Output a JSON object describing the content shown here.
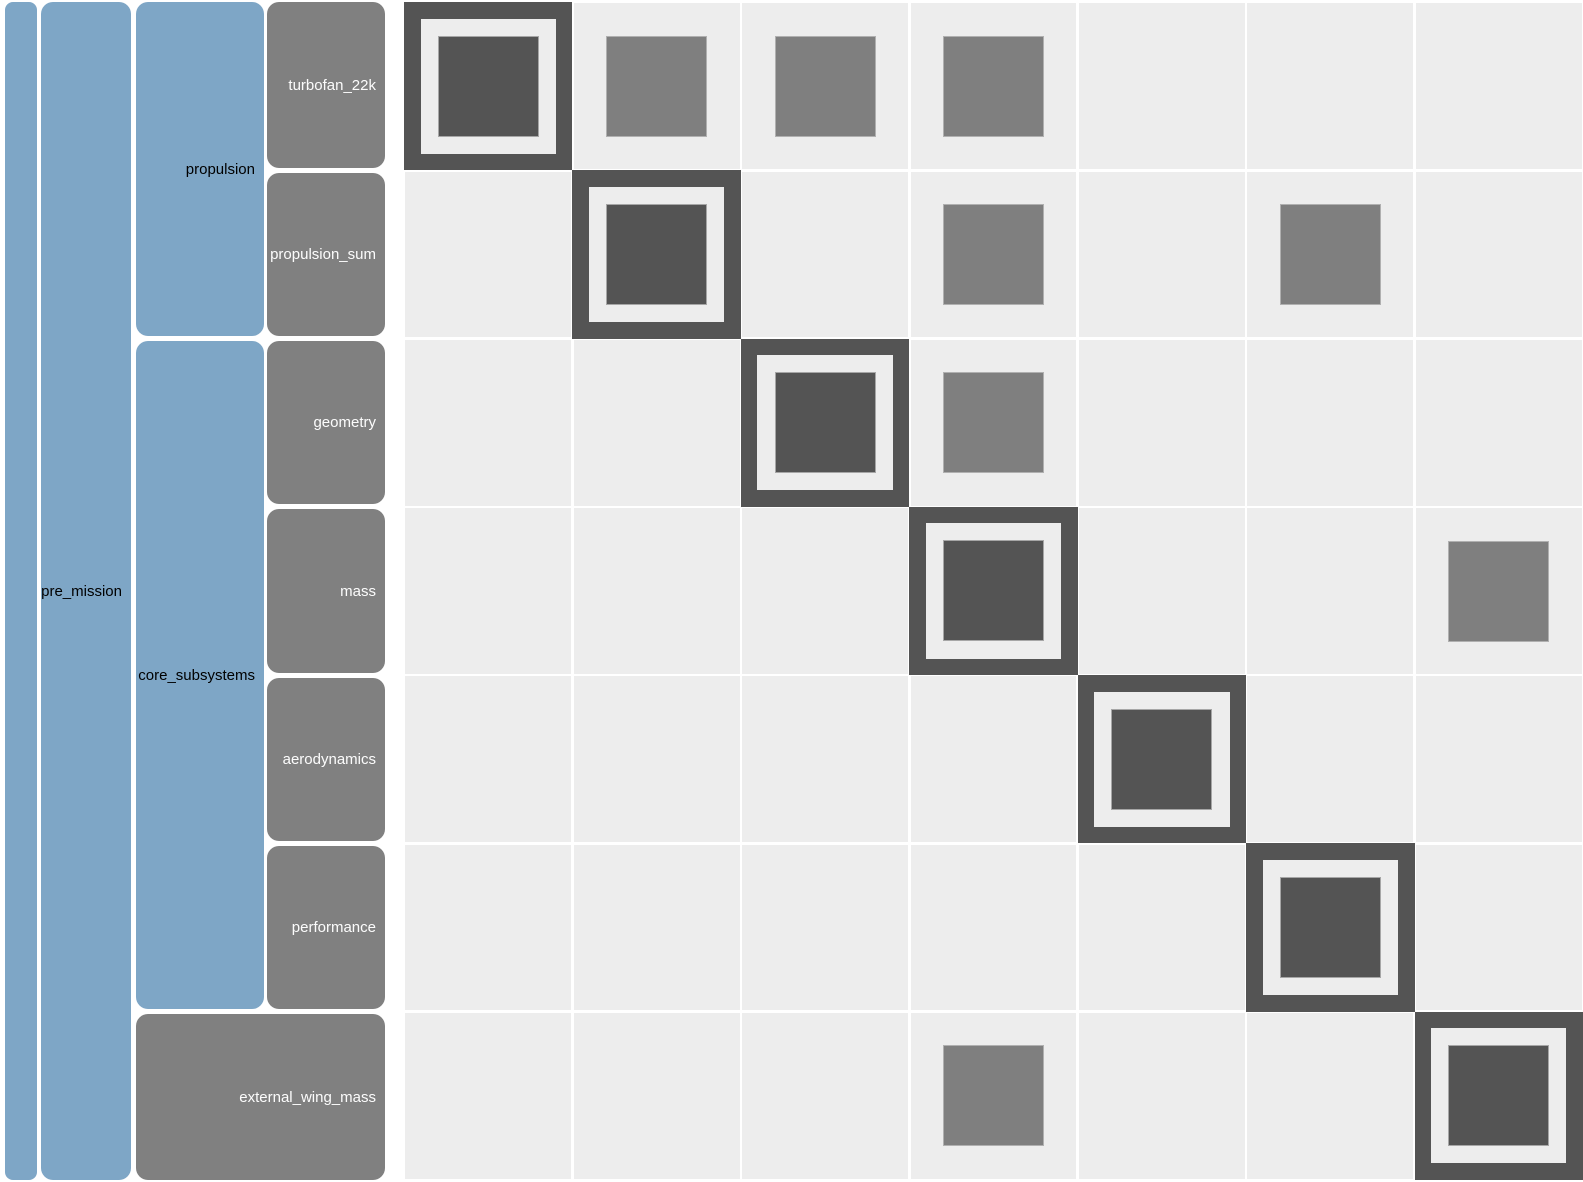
{
  "diagram": {
    "kind": "n2-design-structure-matrix",
    "colors": {
      "group_blue": "#7EA6C6",
      "component_gray": "#808080",
      "diagonal_dark": "#545454",
      "matrix_cell_bg": "#EDEDED",
      "connection_fill": "#7F7F7F",
      "connection_border": "#B0B0B0",
      "grid_line": "#FFFFFF",
      "label_on_blue": "#000000",
      "label_on_gray": "#FCFCFC"
    },
    "tree": {
      "root": {
        "label": ""
      },
      "groups": [
        {
          "label": "pre_mission"
        },
        {
          "label": "propulsion"
        },
        {
          "label": "core_subsystems"
        }
      ],
      "components": [
        {
          "label": "turbofan_22k"
        },
        {
          "label": "propulsion_sum"
        },
        {
          "label": "geometry"
        },
        {
          "label": "mass"
        },
        {
          "label": "aerodynamics"
        },
        {
          "label": "performance"
        },
        {
          "label": "external_wing_mass"
        }
      ]
    },
    "matrix": {
      "size": 7,
      "row_order": [
        "turbofan_22k",
        "propulsion_sum",
        "geometry",
        "mass",
        "aerodynamics",
        "performance",
        "external_wing_mass"
      ],
      "diagonal_cells": [
        1,
        2,
        3,
        4,
        5,
        6,
        7
      ],
      "connections": [
        {
          "row": 1,
          "col": 2,
          "row_system": "turbofan_22k",
          "col_system": "propulsion_sum"
        },
        {
          "row": 1,
          "col": 3,
          "row_system": "turbofan_22k",
          "col_system": "geometry"
        },
        {
          "row": 1,
          "col": 4,
          "row_system": "turbofan_22k",
          "col_system": "mass"
        },
        {
          "row": 2,
          "col": 4,
          "row_system": "propulsion_sum",
          "col_system": "mass"
        },
        {
          "row": 2,
          "col": 6,
          "row_system": "propulsion_sum",
          "col_system": "performance"
        },
        {
          "row": 3,
          "col": 4,
          "row_system": "geometry",
          "col_system": "mass"
        },
        {
          "row": 4,
          "col": 7,
          "row_system": "mass",
          "col_system": "external_wing_mass"
        },
        {
          "row": 7,
          "col": 4,
          "row_system": "external_wing_mass",
          "col_system": "mass"
        }
      ]
    }
  }
}
